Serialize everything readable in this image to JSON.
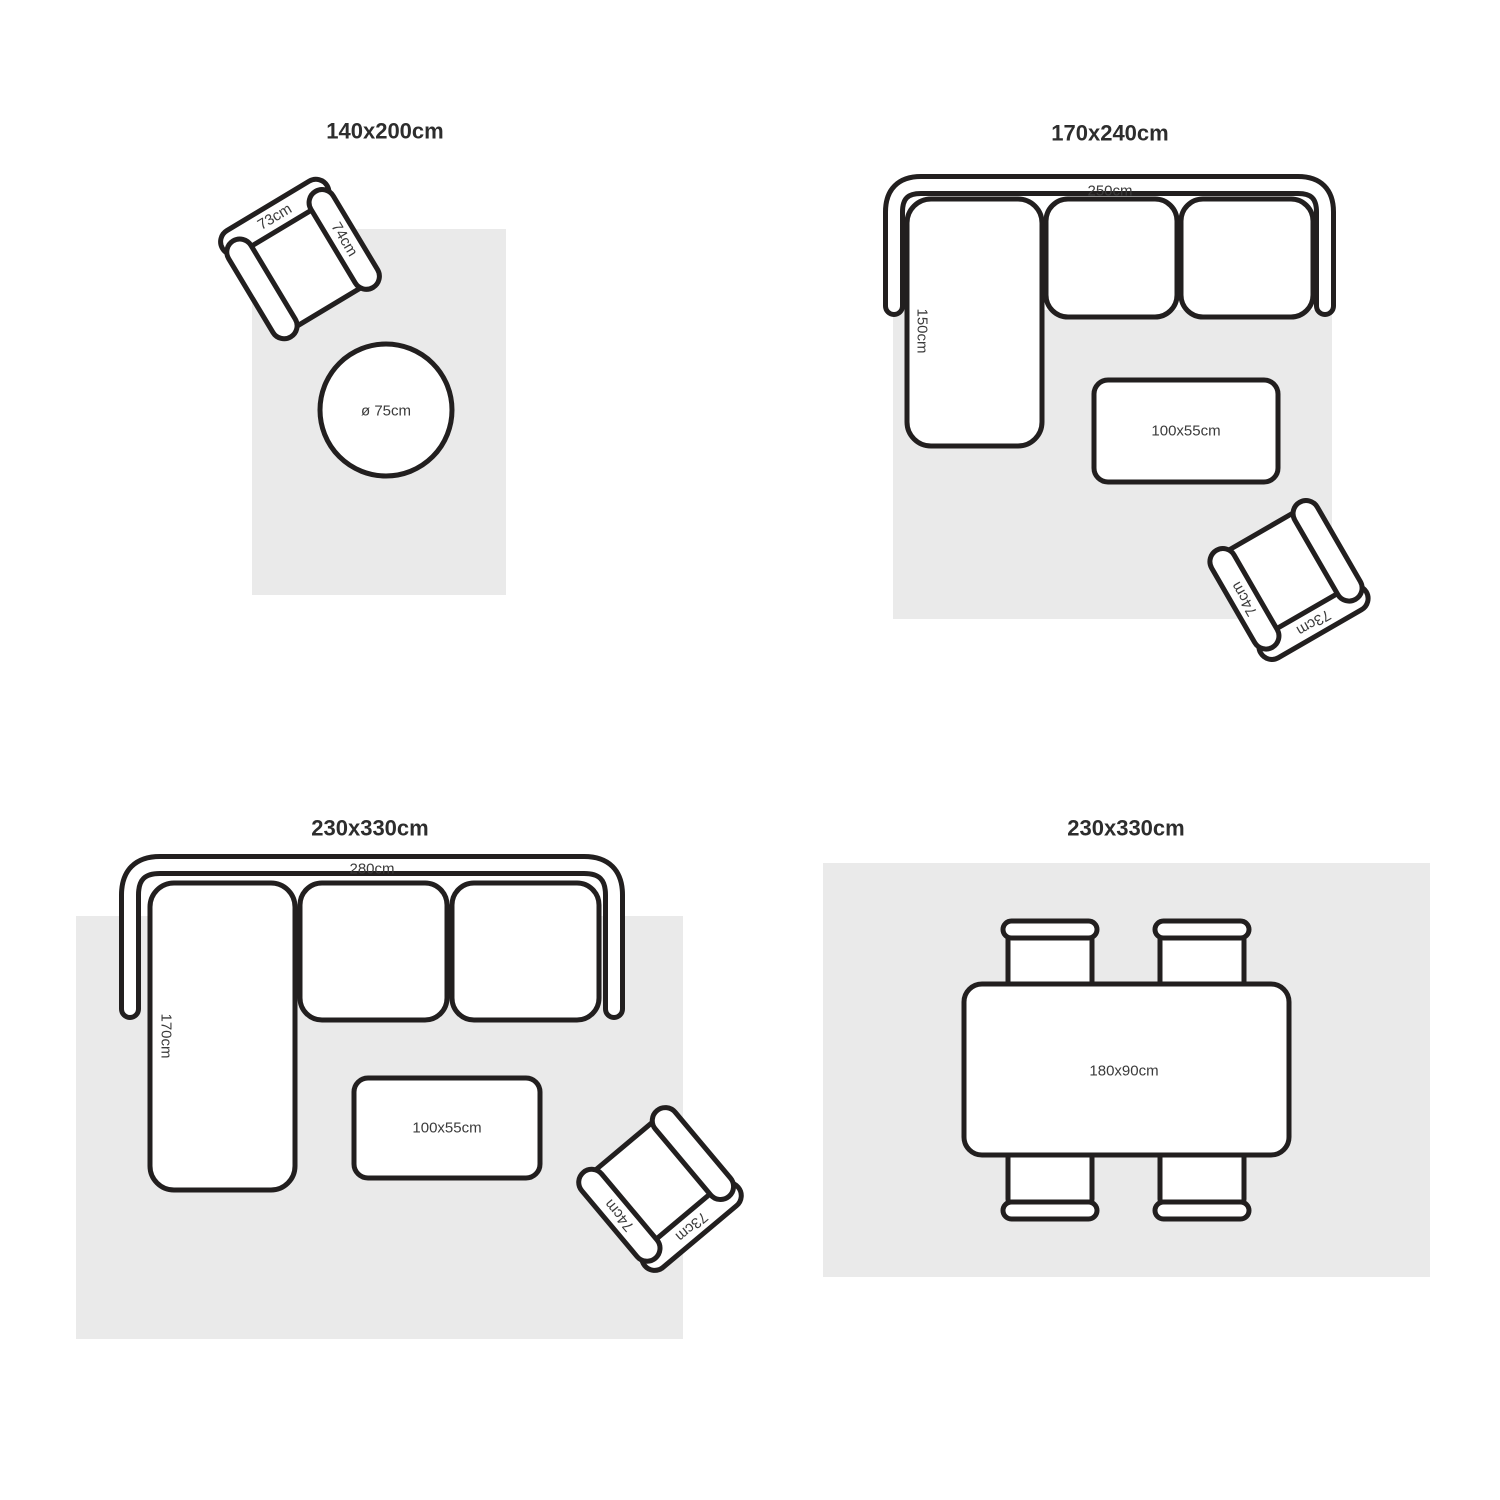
{
  "diagram": {
    "colors": {
      "background": "#ffffff",
      "rug": "#eaeaea",
      "line": "#221f1f",
      "title_text": "#2d2d2d",
      "label_text": "#3b3b3b"
    },
    "panels": [
      {
        "title": "140x200cm",
        "armchair": {
          "width": "73cm",
          "depth": "74cm"
        },
        "round_table": {
          "diameter": "ø 75cm"
        }
      },
      {
        "title": "170x240cm",
        "sofa": {
          "width": "250cm",
          "chaise_depth": "150cm"
        },
        "coffee_table": {
          "size": "100x55cm"
        },
        "armchair": {
          "width": "73cm",
          "depth": "74cm"
        }
      },
      {
        "title": "230x330cm",
        "sofa": {
          "width": "280cm",
          "chaise_depth": "170cm"
        },
        "coffee_table": {
          "size": "100x55cm"
        },
        "armchair": {
          "width": "73cm",
          "depth": "74cm"
        }
      },
      {
        "title": "230x330cm",
        "dining_table": {
          "size": "180x90cm"
        }
      }
    ]
  }
}
